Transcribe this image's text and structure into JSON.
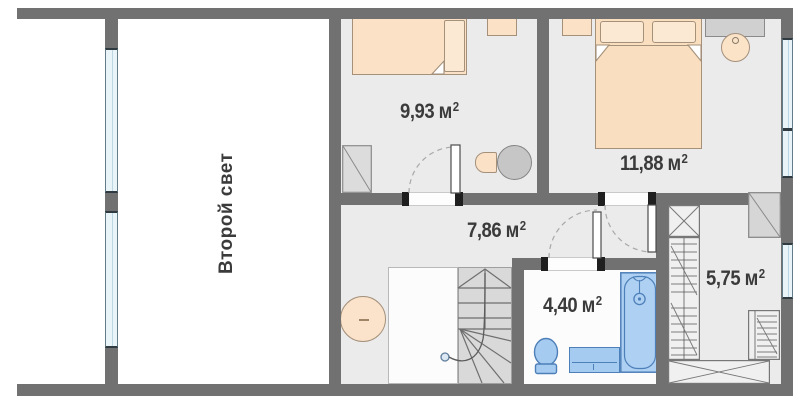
{
  "plan": {
    "void_label": "Второй свет",
    "unit": "м",
    "unit_sup": "2",
    "rooms": [
      {
        "id": "bedroom-small",
        "area": "9,93"
      },
      {
        "id": "bedroom-large",
        "area": "11,88"
      },
      {
        "id": "hall",
        "area": "7,86"
      },
      {
        "id": "bathroom",
        "area": "4,40"
      },
      {
        "id": "dressing-room",
        "area": "5,75"
      }
    ],
    "icons": {
      "single-bed": "rect-with-pillow",
      "double-bed": "rect-with-two-pillows",
      "wardrobe": "square-with-diagonal",
      "stairs": "treads-with-walk-line",
      "bathtub": "rounded-rect",
      "toilet": "oval-with-tank",
      "sink-vanity": "rect",
      "window": "blue-strip",
      "door": "dashed-quarter-arc"
    },
    "colors": {
      "wall": "#717171",
      "floor": "#ebebeb",
      "furniture_peach": "#fbe2c6",
      "fixture_blue": "#a6cbf0",
      "fixture_border": "#4d7fb8",
      "window_blue": "#e9f4f9",
      "text": "#3b3b3b"
    }
  }
}
